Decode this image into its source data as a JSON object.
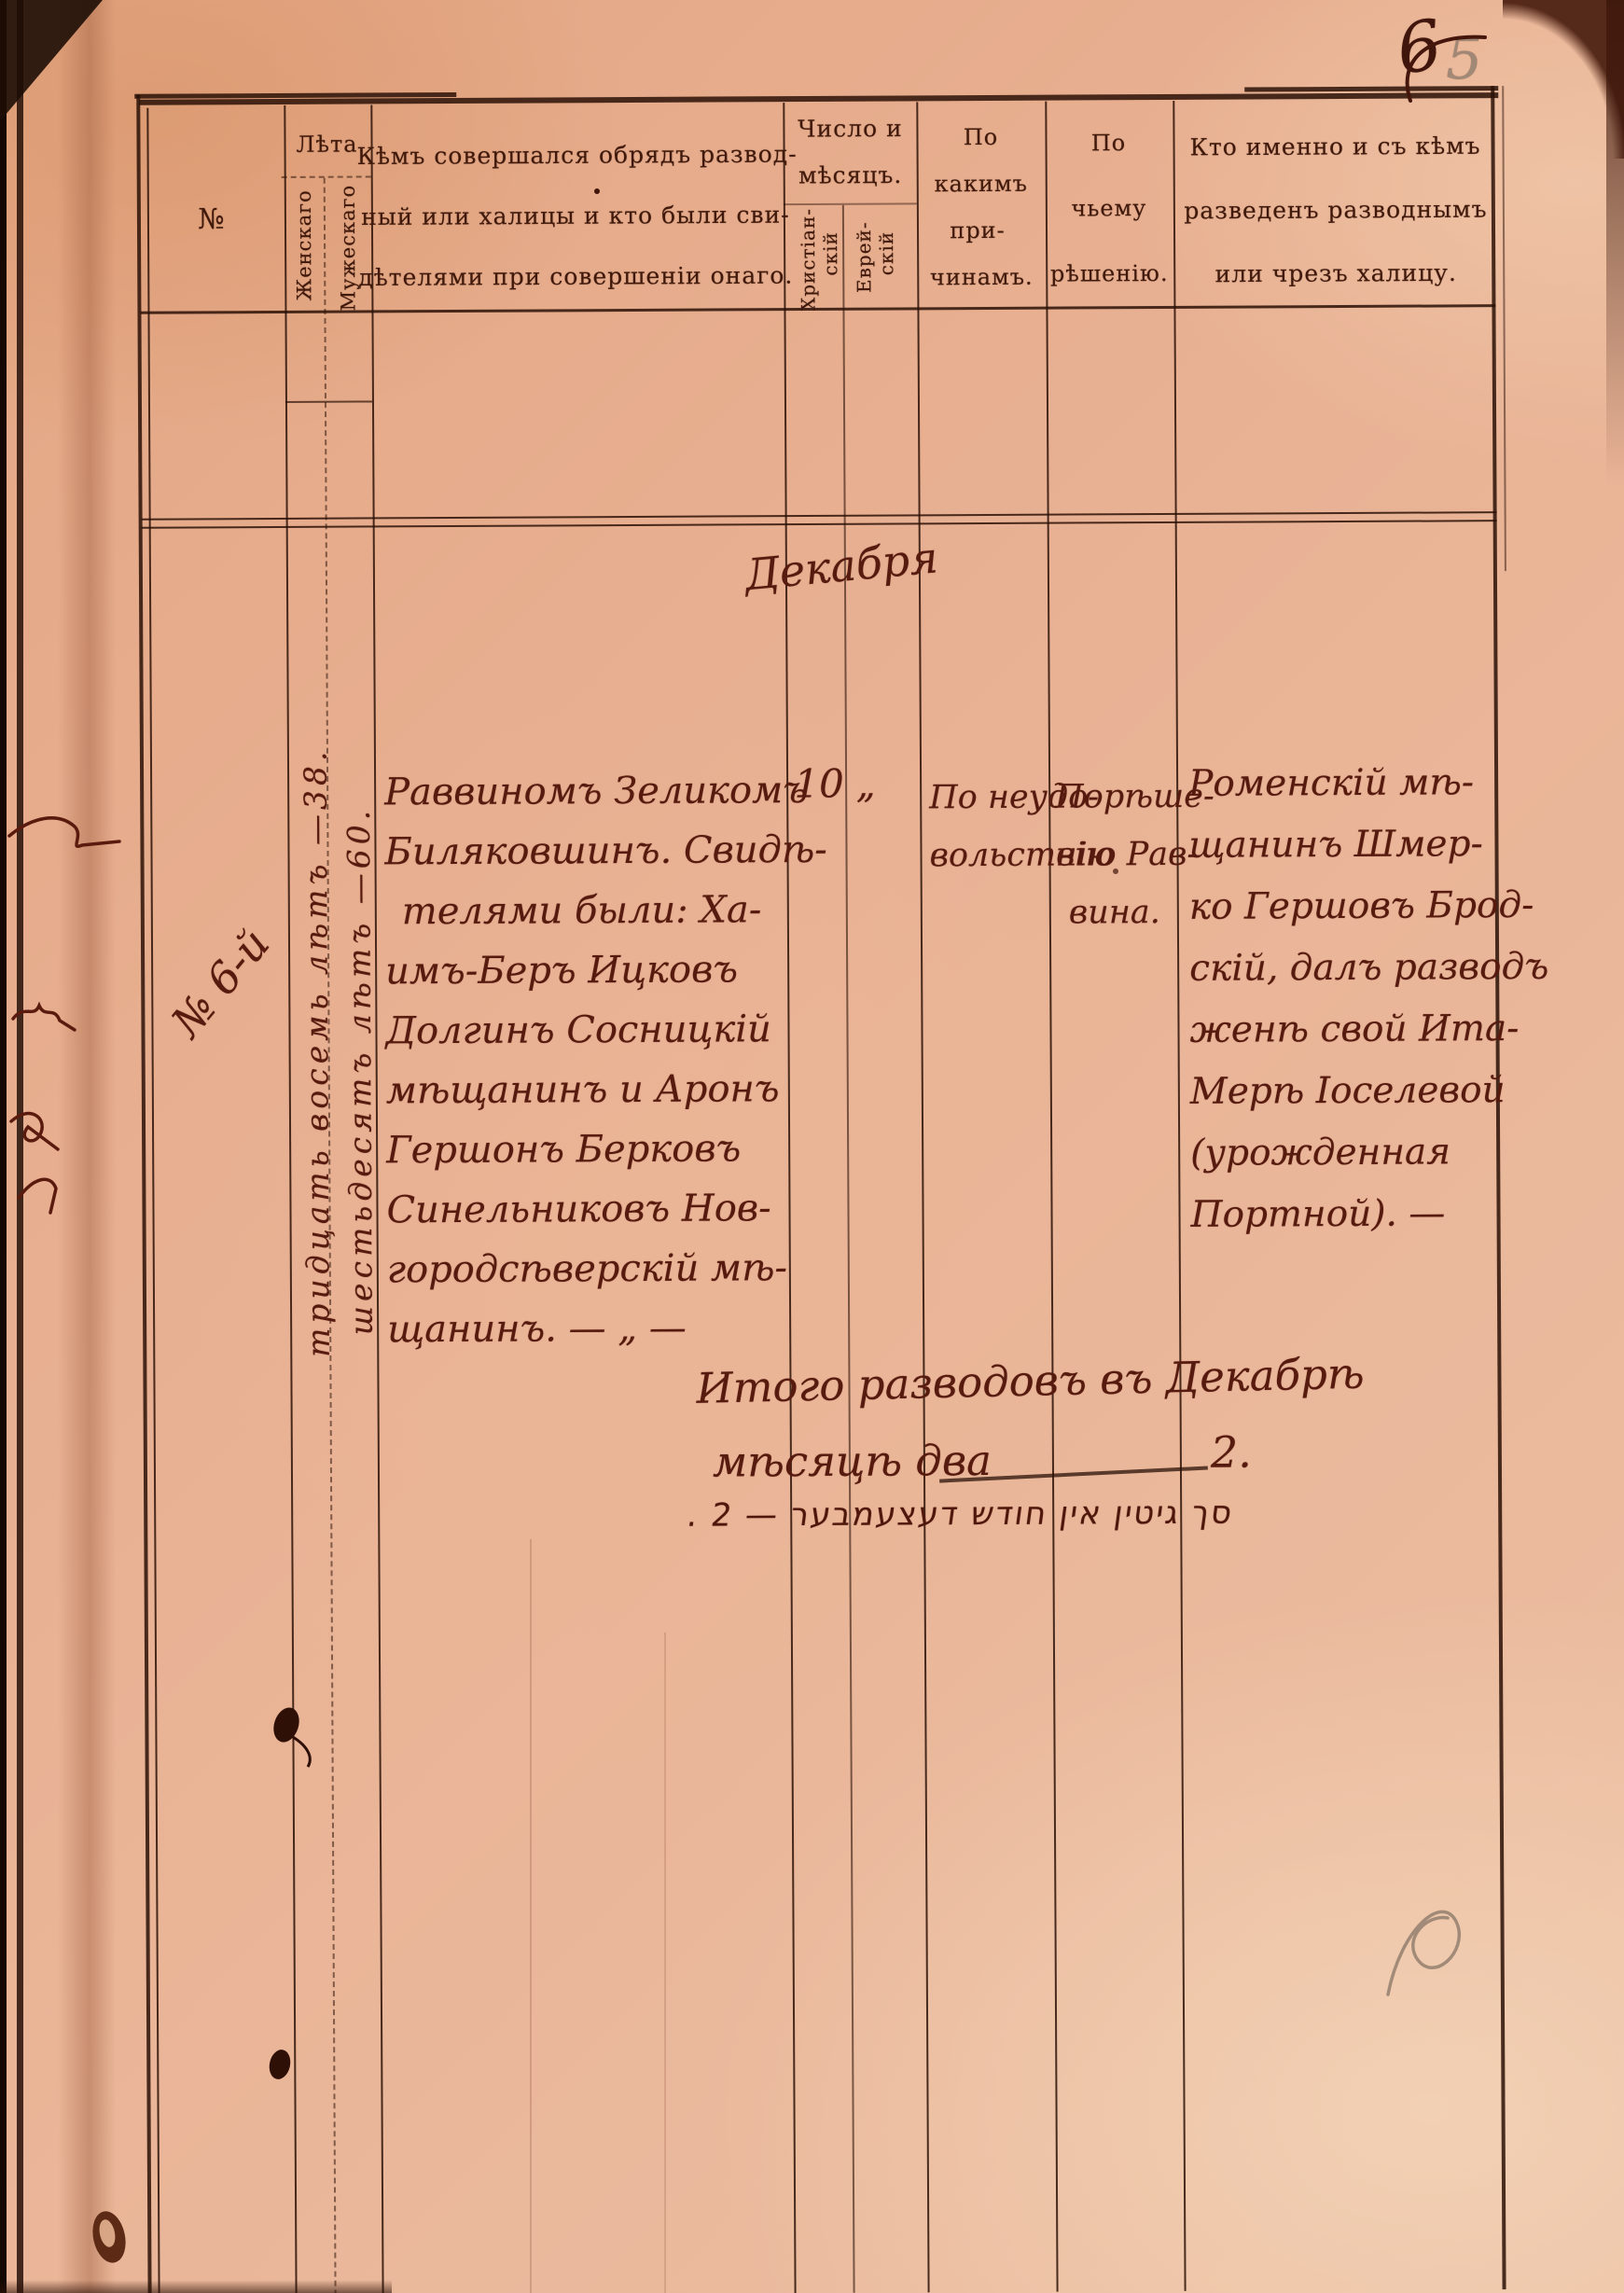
{
  "page": {
    "folio_ink": "6",
    "folio_pencil": "5"
  },
  "colors": {
    "paper": "#e9b295",
    "print_ink": "#40190b",
    "hand_ink": "#571a0e",
    "pencil": "#8f7d6e",
    "rule": "#2a1006"
  },
  "header": {
    "no": "№",
    "years_title": "Лѣта",
    "years_female": "Женскаго",
    "years_male": "Мужескаго",
    "officiant_l1": "Кѣмъ совершался обрядъ развод-",
    "officiant_l2": "ный или халицы и кто были сви-",
    "officiant_l3": "дѣтелями при совершеніи онаго.",
    "date_l1": "Число и",
    "date_l2": "мѣсяцъ.",
    "date_christian_1": "Христіан-",
    "date_christian_2": "скій",
    "date_jewish_1": "Еврей-",
    "date_jewish_2": "скій",
    "reasons_l1": "По",
    "reasons_l2": "какимъ",
    "reasons_l3": "при-",
    "reasons_l4": "чинамъ.",
    "decision_l1": "По",
    "decision_l2": "чьему",
    "decision_l3": "рѣшенію.",
    "who_l1": "Кто именно и съ кѣмъ",
    "who_l2": "разведенъ разводнымъ",
    "who_l3": "или чрезъ халицу."
  },
  "entry": {
    "month": "Декабря",
    "record_no": "№ 6-й",
    "age_female": "тридцать восемь лѣтъ —38.",
    "age_male": "шестьдесятъ лѣтъ —60.",
    "officiant_lines": [
      "Раввиномъ Зеликомъ",
      "Биляковшинъ. Свидѣ-",
      "телями были: Ха-",
      "имъ-Беръ Ицковъ",
      "Долгинъ Сосницкій",
      "мѣщанинъ и Аронъ",
      "Гершонъ Берковъ",
      "Синельниковъ Нов-",
      "городсѣверскій мѣ-",
      "щанинъ. — „ —"
    ],
    "day_christian": "10",
    "day_jewish_ditto": "„",
    "reasons_lines": [
      "По неудо-",
      "вольствію"
    ],
    "decision_lines": [
      "Порѣше-",
      "нію Рав-",
      "вина."
    ],
    "who_lines": [
      "Роменскій мѣ-",
      "щанинъ Шмер-",
      "ко Гершовъ Брод-",
      "скій, далъ разводъ",
      "женѣ свой Ита-",
      "Мерѣ Іоселевой",
      "(урожденная",
      "Портной). —"
    ]
  },
  "summary": {
    "l1": "Итого разводовъ въ Декабрѣ",
    "l2": "мѣсяцѣ два",
    "total": "2.",
    "hebrew": "סך גיטין אין חודש דעצעמבער — 2 ."
  }
}
